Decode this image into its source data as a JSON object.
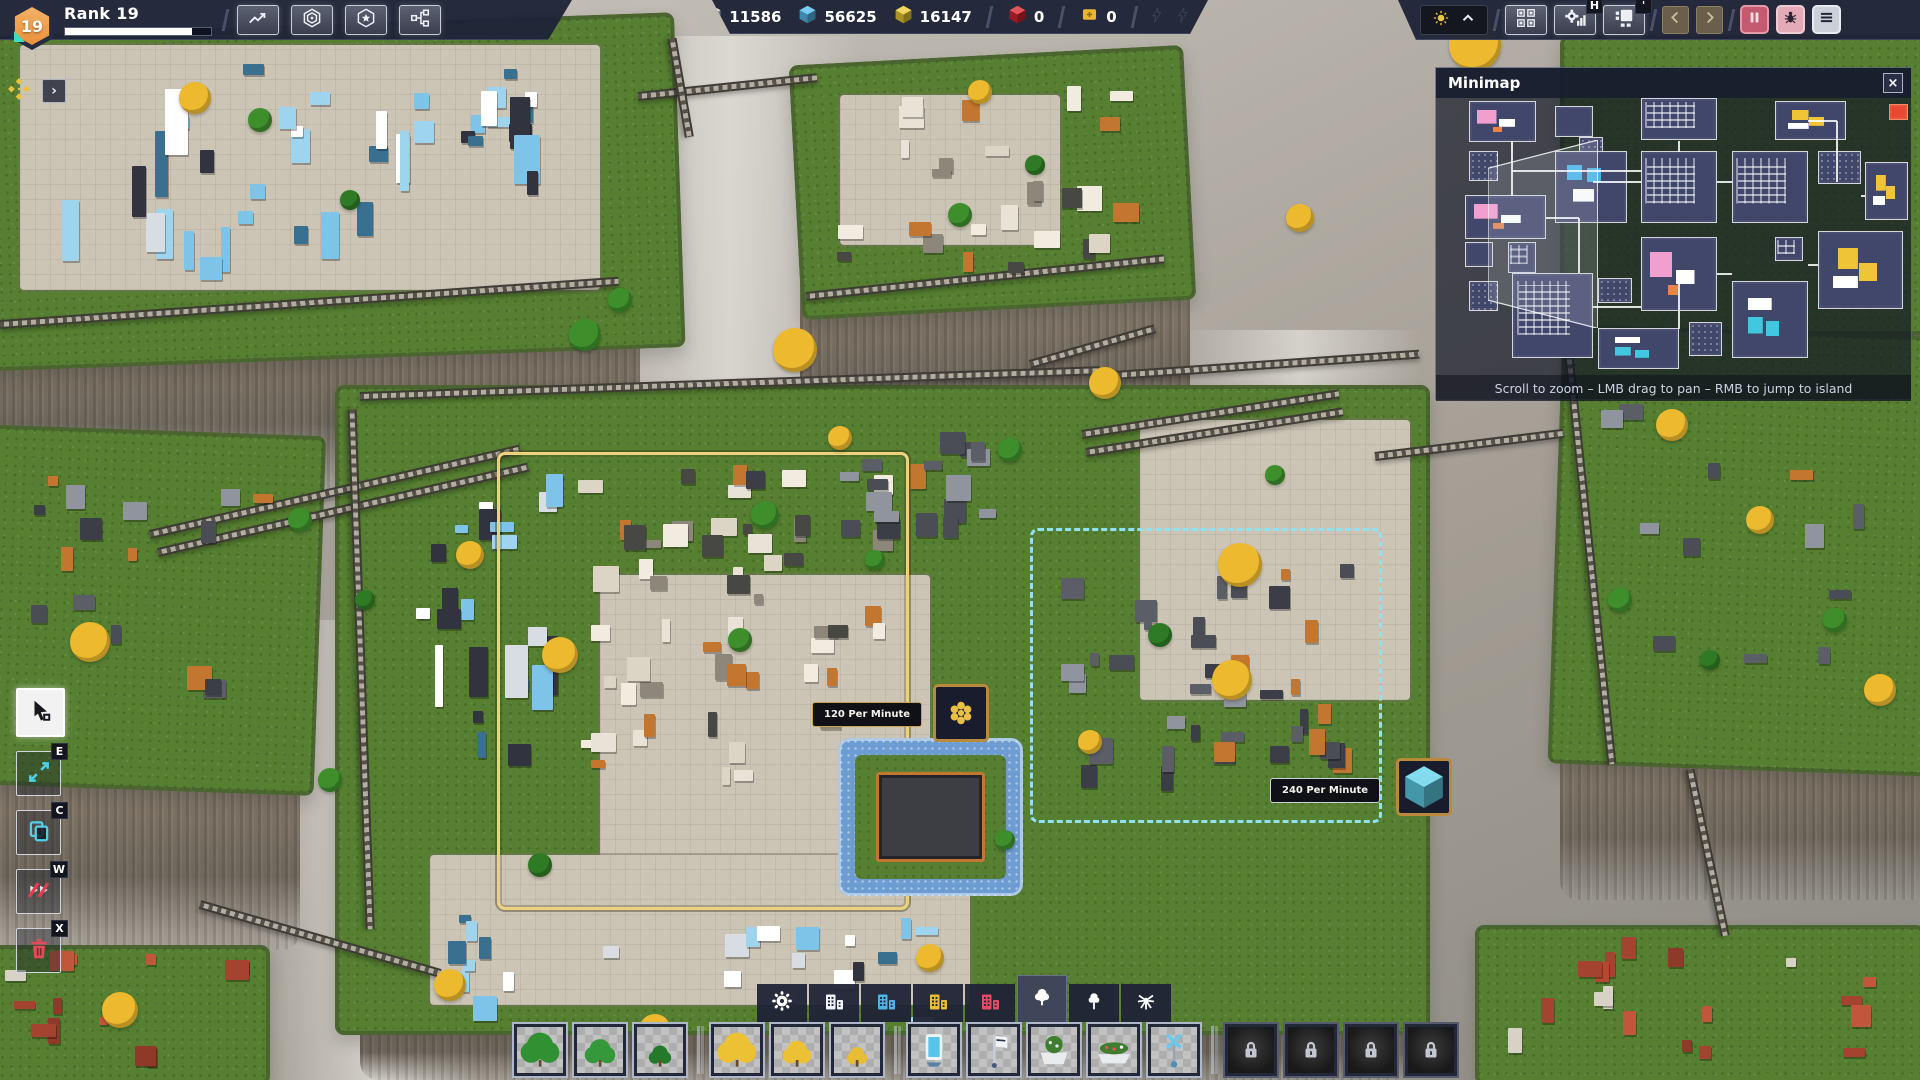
{
  "hud": {
    "rank": {
      "label": "Rank 19",
      "level": "19",
      "progress_pct": 87
    },
    "left_buttons": [
      {
        "name": "statistics-button",
        "icon": "trend-icon"
      },
      {
        "name": "shapes-overview-button",
        "icon": "hex-rings-icon"
      },
      {
        "name": "milestones-button",
        "icon": "hex-star-icon"
      },
      {
        "name": "research-button",
        "icon": "node-graph-icon"
      }
    ],
    "resources": [
      {
        "name": "white-shapes",
        "color": "#e2e6ee",
        "value": "11586",
        "divider_after": false
      },
      {
        "name": "blue-shapes",
        "color": "#55bbee",
        "value": "56625",
        "divider_after": false
      },
      {
        "name": "yellow-shapes",
        "color": "#eecb33",
        "value": "16147",
        "divider_after": true
      },
      {
        "name": "red-shapes",
        "color": "#d8242f",
        "value": "0",
        "divider_after": true
      },
      {
        "name": "blueprint-ticket",
        "color": "#eab62d",
        "value": "0",
        "divider_after": true
      }
    ],
    "energy_bolts": 3,
    "right": {
      "tool_buttons": [
        {
          "name": "platform-manager-button",
          "icon": "platform-icon",
          "badge": ""
        },
        {
          "name": "production-stats-button",
          "icon": "gear-bars-icon",
          "badge": "H"
        },
        {
          "name": "layer-view-button",
          "icon": "layout-icon",
          "badge": "'"
        }
      ]
    },
    "pin_bar": {
      "expand_glyph": "›"
    }
  },
  "minimap": {
    "title": "Minimap",
    "close_glyph": "×",
    "footer": "Scroll to zoom – LMB drag to pan – RMB to jump to island",
    "viewport": {
      "x": 11,
      "y": 15,
      "w": 23,
      "h": 68
    },
    "islands": [
      {
        "x": 7,
        "y": 1,
        "w": 14,
        "h": 15,
        "a": "pink"
      },
      {
        "x": 25,
        "y": 3,
        "w": 8,
        "h": 11,
        "a": "plain"
      },
      {
        "x": 30,
        "y": 14,
        "w": 5,
        "h": 6,
        "a": "dots"
      },
      {
        "x": 43,
        "y": 0,
        "w": 16,
        "h": 15,
        "a": "white"
      },
      {
        "x": 71,
        "y": 1,
        "w": 15,
        "h": 14,
        "a": "yellow"
      },
      {
        "x": 95,
        "y": 2,
        "w": 4,
        "h": 6,
        "a": "red"
      },
      {
        "x": 7,
        "y": 19,
        "w": 6,
        "h": 11,
        "a": "dots"
      },
      {
        "x": 25,
        "y": 19,
        "w": 15,
        "h": 26,
        "a": "blue"
      },
      {
        "x": 43,
        "y": 19,
        "w": 16,
        "h": 26,
        "a": "white"
      },
      {
        "x": 62,
        "y": 19,
        "w": 16,
        "h": 26,
        "a": "white"
      },
      {
        "x": 80,
        "y": 19,
        "w": 9,
        "h": 12,
        "a": "dots"
      },
      {
        "x": 90,
        "y": 23,
        "w": 9,
        "h": 21,
        "a": "yellow"
      },
      {
        "x": 6,
        "y": 35,
        "w": 17,
        "h": 16,
        "a": "pink"
      },
      {
        "x": 15,
        "y": 52,
        "w": 6,
        "h": 11,
        "a": "white"
      },
      {
        "x": 6,
        "y": 52,
        "w": 6,
        "h": 9,
        "a": "plain"
      },
      {
        "x": 43,
        "y": 50,
        "w": 16,
        "h": 27,
        "a": "pink"
      },
      {
        "x": 71,
        "y": 50,
        "w": 6,
        "h": 9,
        "a": "white"
      },
      {
        "x": 80,
        "y": 48,
        "w": 18,
        "h": 28,
        "a": "yellow"
      },
      {
        "x": 7,
        "y": 66,
        "w": 6,
        "h": 11,
        "a": "dots"
      },
      {
        "x": 16,
        "y": 63,
        "w": 17,
        "h": 31,
        "a": "white"
      },
      {
        "x": 34,
        "y": 65,
        "w": 7,
        "h": 9,
        "a": "dots"
      },
      {
        "x": 34,
        "y": 83,
        "w": 17,
        "h": 15,
        "a": "cyan"
      },
      {
        "x": 53,
        "y": 81,
        "w": 7,
        "h": 12,
        "a": "dots"
      },
      {
        "x": 62,
        "y": 66,
        "w": 16,
        "h": 28,
        "a": "cyan"
      }
    ],
    "links": [
      {
        "x1": 16,
        "y1": 15,
        "x2": 16,
        "y2": 35
      },
      {
        "x1": 16,
        "y1": 26,
        "x2": 43,
        "y2": 26
      },
      {
        "x1": 51,
        "y1": 15,
        "x2": 51,
        "y2": 19
      },
      {
        "x1": 59,
        "y1": 30,
        "x2": 62,
        "y2": 30
      },
      {
        "x1": 78,
        "y1": 8,
        "x2": 84,
        "y2": 8
      },
      {
        "x1": 84,
        "y1": 8,
        "x2": 84,
        "y2": 30
      },
      {
        "x1": 33,
        "y1": 30,
        "x2": 43,
        "y2": 30
      },
      {
        "x1": 23,
        "y1": 43,
        "x2": 30,
        "y2": 43
      },
      {
        "x1": 30,
        "y1": 43,
        "x2": 30,
        "y2": 63
      },
      {
        "x1": 33,
        "y1": 75,
        "x2": 43,
        "y2": 75
      },
      {
        "x1": 51,
        "y1": 63,
        "x2": 51,
        "y2": 83
      },
      {
        "x1": 59,
        "y1": 63,
        "x2": 62,
        "y2": 63
      },
      {
        "x1": 78,
        "y1": 60,
        "x2": 80,
        "y2": 60
      },
      {
        "x1": 89,
        "y1": 35,
        "x2": 90,
        "y2": 35
      }
    ]
  },
  "left_toolbar": {
    "tools": [
      {
        "name": "select-tool",
        "hotkey": "",
        "icon": "cursor-icon",
        "selected": true
      },
      {
        "name": "move-tool",
        "hotkey": "E",
        "icon": "move-icon",
        "selected": false
      },
      {
        "name": "copy-tool",
        "hotkey": "C",
        "icon": "copy-icon",
        "selected": false
      },
      {
        "name": "cut-tool",
        "hotkey": "W",
        "icon": "slash-icon",
        "selected": false
      },
      {
        "name": "delete-tool",
        "hotkey": "X",
        "icon": "trash-icon",
        "selected": false
      }
    ]
  },
  "bottom_toolbar": {
    "tabs": [
      {
        "name": "tab-general",
        "icon": "gear",
        "color": "#ffffff",
        "selected": false
      },
      {
        "name": "tab-buildings-white",
        "icon": "buildings",
        "color": "#f0f2f5",
        "selected": false
      },
      {
        "name": "tab-buildings-blue",
        "icon": "buildings",
        "color": "#4fb3e8",
        "selected": false
      },
      {
        "name": "tab-buildings-yellow",
        "icon": "buildings",
        "color": "#edba3a",
        "selected": false
      },
      {
        "name": "tab-buildings-red",
        "icon": "buildings",
        "color": "#ea4a5f",
        "selected": false
      },
      {
        "name": "tab-trees",
        "icon": "tree",
        "color": "#ffffff",
        "selected": true
      },
      {
        "name": "tab-trees-alt",
        "icon": "tree2",
        "color": "#ffffff",
        "selected": false
      },
      {
        "name": "tab-plants",
        "icon": "plant",
        "color": "#ffffff",
        "selected": false
      }
    ],
    "items": [
      {
        "name": "item-tree-green-large",
        "type": "tree",
        "color": "#2f9132",
        "size": 19,
        "sep_after": false
      },
      {
        "name": "item-tree-green-medium",
        "type": "tree",
        "color": "#35983a",
        "size": 15,
        "sep_after": false
      },
      {
        "name": "item-tree-green-small",
        "type": "tree",
        "color": "#237a2b",
        "size": 11,
        "sep_after": true
      },
      {
        "name": "item-tree-yellow-large",
        "type": "tree",
        "color": "#ecc134",
        "size": 19,
        "sep_after": false
      },
      {
        "name": "item-tree-yellow-medium",
        "type": "tree",
        "color": "#ecc134",
        "size": 14,
        "sep_after": false
      },
      {
        "name": "item-tree-yellow-small",
        "type": "tree",
        "color": "#e7bd33",
        "size": 10,
        "sep_after": true
      },
      {
        "name": "item-billboard",
        "type": "billboard",
        "sep_after": false
      },
      {
        "name": "item-banner",
        "type": "banner",
        "sep_after": false
      },
      {
        "name": "item-planter",
        "type": "planter",
        "sep_after": false
      },
      {
        "name": "item-flowerbed",
        "type": "flowerbed",
        "sep_after": false
      },
      {
        "name": "item-lamp",
        "type": "lamp",
        "sep_after": true
      },
      {
        "name": "item-locked-1",
        "type": "locked",
        "sep_after": false
      },
      {
        "name": "item-locked-2",
        "type": "locked",
        "sep_after": false
      },
      {
        "name": "item-locked-3",
        "type": "locked",
        "sep_after": false
      },
      {
        "name": "item-locked-4",
        "type": "locked",
        "sep_after": false
      }
    ]
  },
  "scene": {
    "throughput_labels": [
      {
        "text": "120 Per Minute",
        "x": 812,
        "y": 702,
        "icon_x": 933,
        "icon_y": 684,
        "icon": "gold-shape",
        "style": "gold"
      },
      {
        "text": "240 Per Minute",
        "x": 1270,
        "y": 778,
        "icon_x": 1396,
        "icon_y": 758,
        "icon": "blue-crystal",
        "style": "light"
      }
    ],
    "regions": [
      {
        "name": "build-zone-yellow",
        "x": 497,
        "y": 452,
        "w": 412,
        "h": 458,
        "color": "#ecd27c",
        "style": "solid"
      },
      {
        "name": "build-zone-cyan",
        "x": 1030,
        "y": 528,
        "w": 352,
        "h": 295,
        "color": "#8fe2f2",
        "style": "dashed"
      }
    ],
    "islands": [
      {
        "name": "island-top-left",
        "x": -60,
        "y": 25,
        "w": 740,
        "h": 335,
        "rot": -2
      },
      {
        "name": "island-top-center",
        "x": 795,
        "y": 55,
        "w": 395,
        "h": 255,
        "rot": -3
      },
      {
        "name": "island-top-right",
        "x": 1560,
        "y": 35,
        "w": 380,
        "h": 300,
        "rot": 0
      },
      {
        "name": "island-right",
        "x": 1555,
        "y": 330,
        "w": 380,
        "h": 440,
        "rot": 2
      },
      {
        "name": "island-left",
        "x": -30,
        "y": 430,
        "w": 350,
        "h": 360,
        "rot": 2
      },
      {
        "name": "island-center",
        "x": 335,
        "y": 385,
        "w": 1095,
        "h": 650,
        "rot": 0
      },
      {
        "name": "island-bottom-left",
        "x": -20,
        "y": 945,
        "w": 290,
        "h": 140,
        "rot": 0
      },
      {
        "name": "island-bottom-right",
        "x": 1475,
        "y": 925,
        "w": 450,
        "h": 160,
        "rot": 0
      }
    ],
    "cliffs": [
      {
        "x": -60,
        "y": 300,
        "w": 700,
        "h": 190
      },
      {
        "x": 800,
        "y": 270,
        "w": 390,
        "h": 170
      },
      {
        "x": -30,
        "y": 740,
        "w": 330,
        "h": 210
      },
      {
        "x": 1560,
        "y": 720,
        "w": 370,
        "h": 180
      },
      {
        "x": 360,
        "y": 1000,
        "w": 1050,
        "h": 80
      },
      {
        "x": 1560,
        "y": 300,
        "w": 370,
        "h": 70
      }
    ],
    "plazas": [
      {
        "x": 20,
        "y": 45,
        "w": 580,
        "h": 245
      },
      {
        "x": 600,
        "y": 575,
        "w": 330,
        "h": 310
      },
      {
        "x": 1140,
        "y": 420,
        "w": 270,
        "h": 280
      },
      {
        "x": 430,
        "y": 855,
        "w": 540,
        "h": 150
      },
      {
        "x": 840,
        "y": 95,
        "w": 220,
        "h": 150
      }
    ],
    "clusters": [
      {
        "x": 40,
        "y": 55,
        "w": 500,
        "h": 225,
        "palette": "blue",
        "n": 40,
        "tall": true
      },
      {
        "x": 830,
        "y": 85,
        "w": 320,
        "h": 190,
        "palette": "whiteorange",
        "n": 26,
        "tall": false
      },
      {
        "x": 415,
        "y": 470,
        "w": 150,
        "h": 310,
        "palette": "blue",
        "n": 22,
        "tall": true
      },
      {
        "x": 565,
        "y": 465,
        "w": 330,
        "h": 320,
        "palette": "whiteorange",
        "n": 55,
        "tall": false
      },
      {
        "x": 1055,
        "y": 555,
        "w": 300,
        "h": 240,
        "palette": "dark",
        "n": 38,
        "tall": false
      },
      {
        "x": 420,
        "y": 915,
        "w": 540,
        "h": 130,
        "palette": "blue",
        "n": 26,
        "tall": false
      },
      {
        "x": 30,
        "y": 470,
        "w": 250,
        "h": 260,
        "palette": "dark",
        "n": 16,
        "tall": false
      },
      {
        "x": 1590,
        "y": 380,
        "w": 280,
        "h": 300,
        "palette": "dark",
        "n": 12,
        "tall": false
      },
      {
        "x": 0,
        "y": 950,
        "w": 250,
        "h": 120,
        "palette": "red",
        "n": 14,
        "tall": false
      },
      {
        "x": 1500,
        "y": 935,
        "w": 400,
        "h": 135,
        "palette": "red",
        "n": 18,
        "tall": false
      },
      {
        "x": 700,
        "y": 430,
        "w": 320,
        "h": 110,
        "palette": "dark",
        "n": 20,
        "tall": false
      }
    ],
    "bridges": [
      {
        "x": 638,
        "y": 92,
        "len": 180,
        "angle": -6
      },
      {
        "x": 672,
        "y": 34,
        "len": 100,
        "angle": 80
      },
      {
        "x": 150,
        "y": 530,
        "len": 380,
        "angle": -13
      },
      {
        "x": 158,
        "y": 548,
        "len": 380,
        "angle": -13
      },
      {
        "x": 1082,
        "y": 430,
        "len": 260,
        "angle": -9
      },
      {
        "x": 1086,
        "y": 448,
        "len": 260,
        "angle": -9
      },
      {
        "x": 1375,
        "y": 452,
        "len": 190,
        "angle": -7
      },
      {
        "x": 200,
        "y": 900,
        "len": 250,
        "angle": 16
      },
      {
        "x": 1690,
        "y": 765,
        "len": 170,
        "angle": 78
      },
      {
        "x": 1030,
        "y": 360,
        "len": 130,
        "angle": -16
      },
      {
        "x": 360,
        "y": 392,
        "len": 740,
        "angle": -2
      },
      {
        "x": 352,
        "y": 405,
        "len": 520,
        "angle": 88
      },
      {
        "x": 1100,
        "y": 372,
        "len": 320,
        "angle": -4
      },
      {
        "x": 0,
        "y": 320,
        "len": 620,
        "angle": -4
      },
      {
        "x": 806,
        "y": 292,
        "len": 360,
        "angle": -6
      },
      {
        "x": 1568,
        "y": 342,
        "len": 420,
        "angle": 84
      }
    ],
    "trees": [
      {
        "x": 795,
        "y": 350,
        "r": 22,
        "c": "#ecb92f"
      },
      {
        "x": 1105,
        "y": 383,
        "r": 16,
        "c": "#ecb92f"
      },
      {
        "x": 1240,
        "y": 565,
        "r": 22,
        "c": "#ecb92f"
      },
      {
        "x": 1232,
        "y": 680,
        "r": 20,
        "c": "#ecb92f"
      },
      {
        "x": 560,
        "y": 655,
        "r": 18,
        "c": "#ecb92f"
      },
      {
        "x": 470,
        "y": 555,
        "r": 14,
        "c": "#ecb92f"
      },
      {
        "x": 90,
        "y": 642,
        "r": 20,
        "c": "#ecb92f"
      },
      {
        "x": 1475,
        "y": 45,
        "r": 26,
        "c": "#ecb92f"
      },
      {
        "x": 1300,
        "y": 218,
        "r": 14,
        "c": "#ecb92f"
      },
      {
        "x": 980,
        "y": 92,
        "r": 12,
        "c": "#ecb92f"
      },
      {
        "x": 1672,
        "y": 425,
        "r": 16,
        "c": "#ecb92f"
      },
      {
        "x": 1760,
        "y": 520,
        "r": 14,
        "c": "#ecb92f"
      },
      {
        "x": 1880,
        "y": 690,
        "r": 16,
        "c": "#ecb92f"
      },
      {
        "x": 450,
        "y": 985,
        "r": 16,
        "c": "#ecb92f"
      },
      {
        "x": 120,
        "y": 1010,
        "r": 18,
        "c": "#ecb92f"
      },
      {
        "x": 1090,
        "y": 742,
        "r": 12,
        "c": "#ecb92f"
      },
      {
        "x": 930,
        "y": 958,
        "r": 14,
        "c": "#ecb92f"
      },
      {
        "x": 655,
        "y": 1030,
        "r": 16,
        "c": "#ecb92f"
      },
      {
        "x": 840,
        "y": 438,
        "r": 12,
        "c": "#ecb92f"
      },
      {
        "x": 195,
        "y": 98,
        "r": 16,
        "c": "#ecb92f"
      },
      {
        "x": 585,
        "y": 335,
        "r": 16,
        "c": "#3e8f2c"
      },
      {
        "x": 620,
        "y": 300,
        "r": 12,
        "c": "#3e8f2c"
      },
      {
        "x": 765,
        "y": 515,
        "r": 14,
        "c": "#3e8f2c"
      },
      {
        "x": 300,
        "y": 520,
        "r": 12,
        "c": "#3e8f2c"
      },
      {
        "x": 365,
        "y": 600,
        "r": 10,
        "c": "#2f7a24"
      },
      {
        "x": 1010,
        "y": 450,
        "r": 12,
        "c": "#3e8f2c"
      },
      {
        "x": 1160,
        "y": 635,
        "r": 12,
        "c": "#2f7a24"
      },
      {
        "x": 875,
        "y": 560,
        "r": 10,
        "c": "#3e8f2c"
      },
      {
        "x": 1275,
        "y": 475,
        "r": 10,
        "c": "#3e8f2c"
      },
      {
        "x": 330,
        "y": 780,
        "r": 12,
        "c": "#3e8f2c"
      },
      {
        "x": 540,
        "y": 865,
        "r": 12,
        "c": "#2f7a24"
      },
      {
        "x": 1005,
        "y": 840,
        "r": 10,
        "c": "#3e8f2c"
      },
      {
        "x": 1620,
        "y": 600,
        "r": 12,
        "c": "#3e8f2c"
      },
      {
        "x": 1710,
        "y": 660,
        "r": 10,
        "c": "#2f7a24"
      },
      {
        "x": 1835,
        "y": 620,
        "r": 12,
        "c": "#3e8f2c"
      },
      {
        "x": 960,
        "y": 215,
        "r": 12,
        "c": "#3e8f2c"
      },
      {
        "x": 1035,
        "y": 165,
        "r": 10,
        "c": "#2f7a24"
      },
      {
        "x": 260,
        "y": 120,
        "r": 12,
        "c": "#3e8f2c"
      },
      {
        "x": 350,
        "y": 200,
        "r": 10,
        "c": "#2f7a24"
      },
      {
        "x": 740,
        "y": 640,
        "r": 12,
        "c": "#3e8f2c"
      }
    ],
    "moat": {
      "x": 838,
      "y": 738,
      "w": 185,
      "h": 158
    }
  }
}
